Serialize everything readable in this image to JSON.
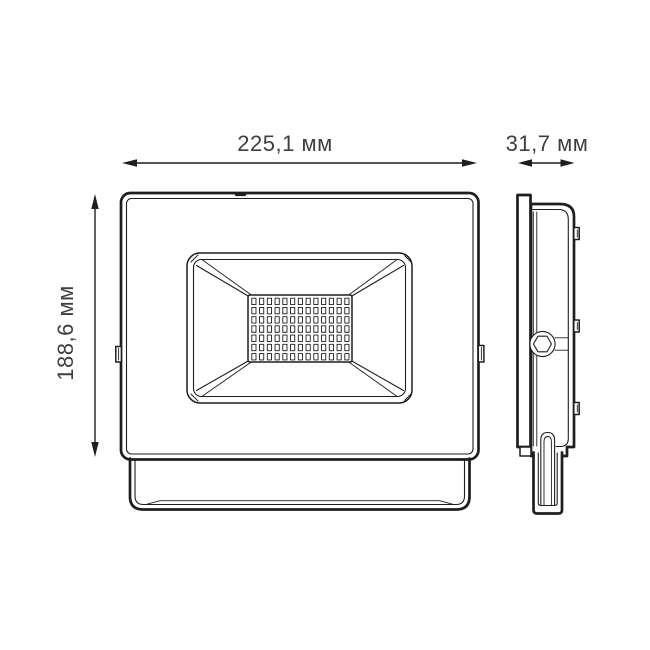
{
  "drawing": {
    "type": "technical-dimension-drawing",
    "subject": "LED floodlight",
    "dimensions": {
      "width_label": "225,1 мм",
      "depth_label": "31,7 мм",
      "height_label": "188,6 мм"
    },
    "views": {
      "front": {
        "led_grid": {
          "rows": 7,
          "cols": 13
        }
      },
      "side": {
        "clip_count": 3
      }
    },
    "icons": {
      "arrowhead": "solid-triangle",
      "bolt_head": "hexagon-in-circle"
    },
    "colors": {
      "line": "#1e1e1e",
      "dim_text": "#3f3f3f",
      "background": "#ffffff"
    }
  }
}
